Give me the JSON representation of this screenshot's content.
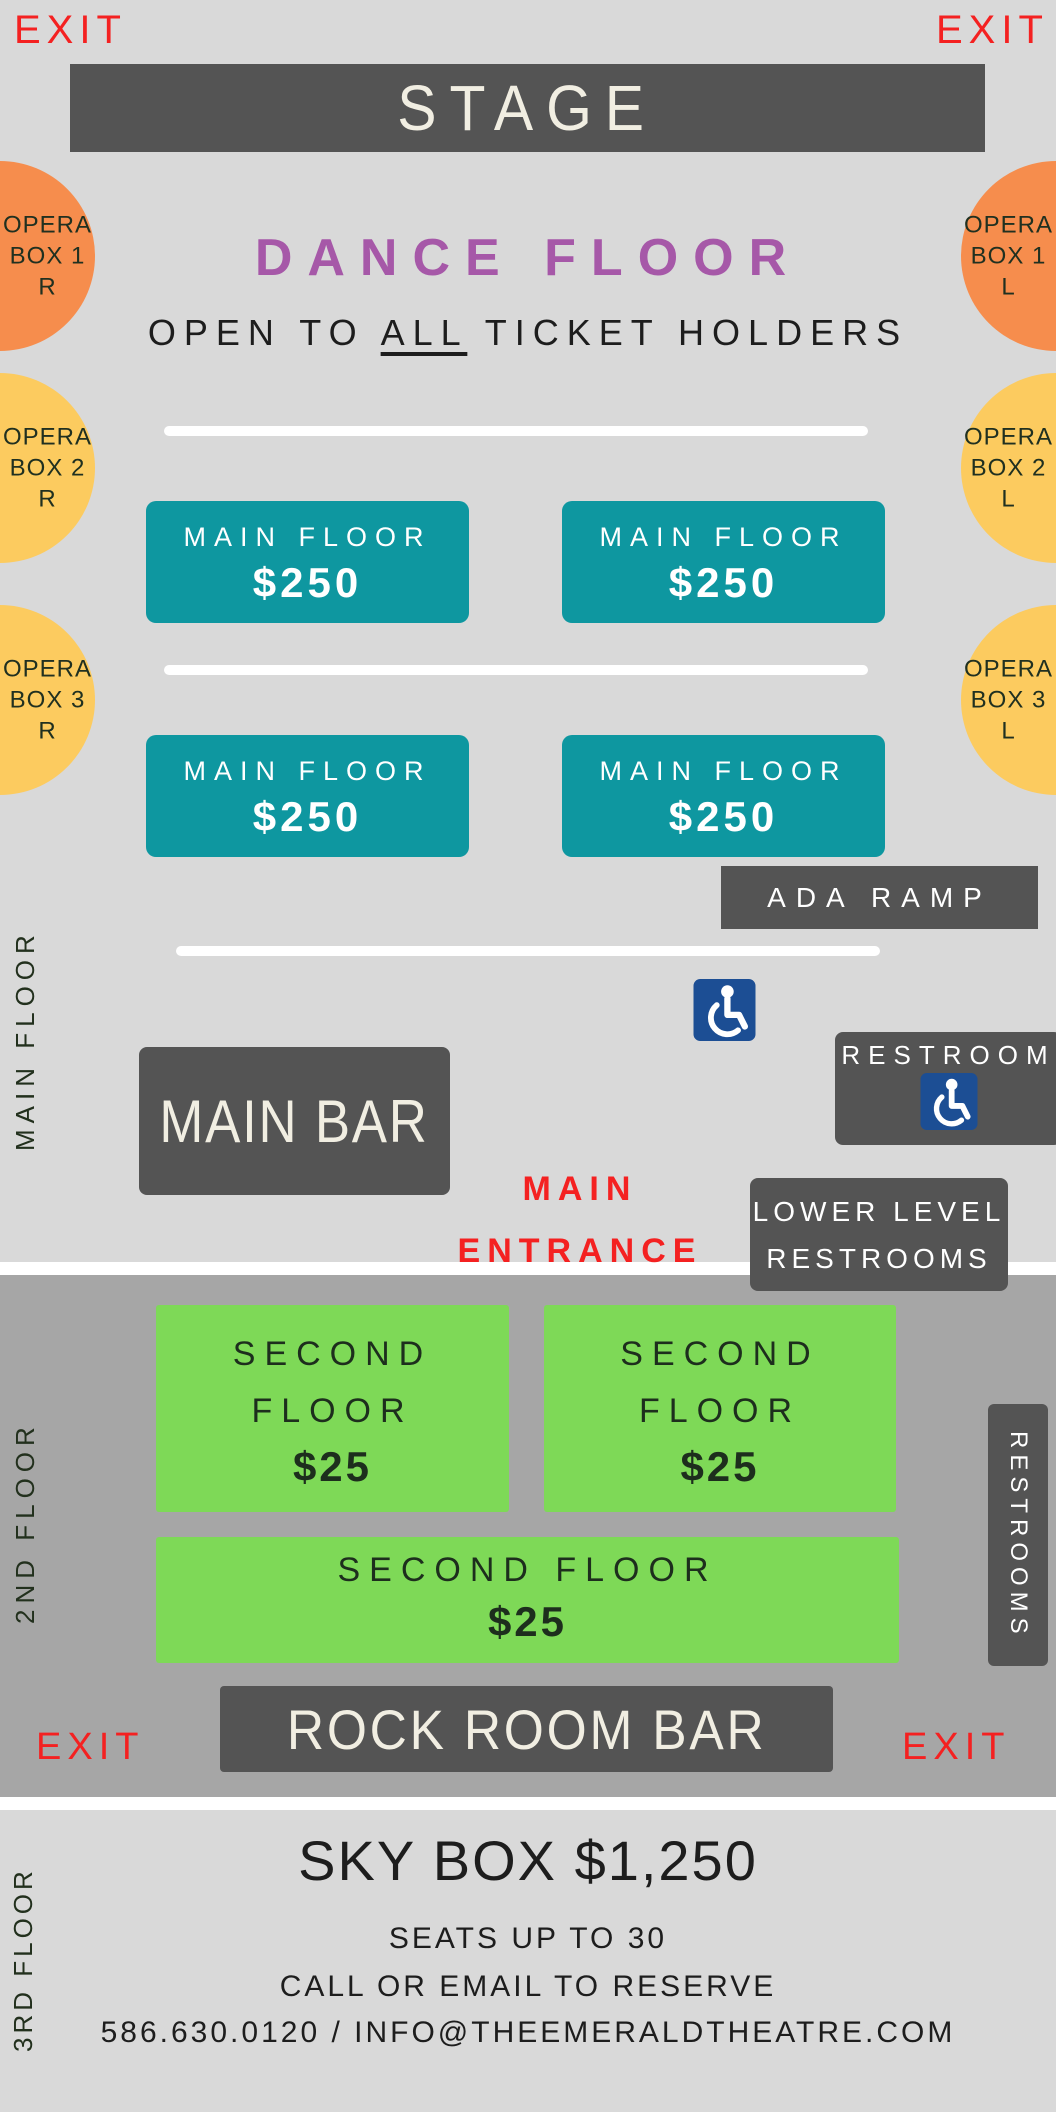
{
  "colors": {
    "background_light": "#d9d9d9",
    "background_band": "#a6a6a6",
    "dark_box": "#545454",
    "teal": "#0e97a0",
    "green": "#7ed957",
    "orange": "#f68d4d",
    "yellow": "#fccb5f",
    "red": "#f42121",
    "purple": "#a658a8",
    "cream_text": "#f1eee2",
    "wheelchair_blue": "#1c4e94"
  },
  "exits": {
    "top_left": "EXIT",
    "top_right": "EXIT",
    "bottom_left": "EXIT",
    "bottom_right": "EXIT"
  },
  "stage": {
    "label": "STAGE"
  },
  "dance_floor": {
    "title": "DANCE FLOOR",
    "open_prefix": "OPEN TO",
    "open_emphasis": "ALL",
    "open_suffix": "TICKET HOLDERS"
  },
  "opera_boxes": [
    {
      "id": "1R",
      "lines": [
        "OPERA",
        "BOX 1",
        "R"
      ],
      "color": "#f68d4d"
    },
    {
      "id": "2R",
      "lines": [
        "OPERA",
        "BOX 2",
        "R"
      ],
      "color": "#fccb5f"
    },
    {
      "id": "3R",
      "lines": [
        "OPERA",
        "BOX 3",
        "R"
      ],
      "color": "#fccb5f"
    },
    {
      "id": "1L",
      "lines": [
        "OPERA",
        "BOX 1",
        "L"
      ],
      "color": "#f68d4d"
    },
    {
      "id": "2L",
      "lines": [
        "OPERA",
        "BOX 2",
        "L"
      ],
      "color": "#fccb5f"
    },
    {
      "id": "3L",
      "lines": [
        "OPERA",
        "BOX 3",
        "L"
      ],
      "color": "#fccb5f"
    }
  ],
  "main_floor": {
    "side_label": "MAIN FLOOR",
    "sections": [
      {
        "name": "MAIN FLOOR",
        "price": "$250"
      },
      {
        "name": "MAIN FLOOR",
        "price": "$250"
      },
      {
        "name": "MAIN FLOOR",
        "price": "$250"
      },
      {
        "name": "MAIN FLOOR",
        "price": "$250"
      }
    ],
    "ada_ramp_label": "ADA RAMP",
    "main_bar_label": "MAIN BAR",
    "restroom_label": "RESTROOM",
    "entrance": {
      "line1": "MAIN",
      "line2": "ENTRANCE"
    },
    "lower_level": {
      "line1": "LOWER LEVEL",
      "line2": "RESTROOMS"
    }
  },
  "second_floor": {
    "side_label": "2ND FLOOR",
    "sections": [
      {
        "line1": "SECOND",
        "line2": "FLOOR",
        "price": "$25"
      },
      {
        "line1": "SECOND",
        "line2": "FLOOR",
        "price": "$25"
      },
      {
        "line1": "SECOND FLOOR",
        "price": "$25"
      }
    ],
    "restrooms_label": "RESTROOMS",
    "bar_label": "ROCK ROOM BAR"
  },
  "third_floor": {
    "side_label": "3RD FLOOR",
    "title": "SKY BOX $1,250",
    "details": [
      "SEATS UP TO 30",
      "CALL OR EMAIL TO RESERVE",
      "586.630.0120 / INFO@THEEMERALDTHEATRE.COM"
    ]
  }
}
